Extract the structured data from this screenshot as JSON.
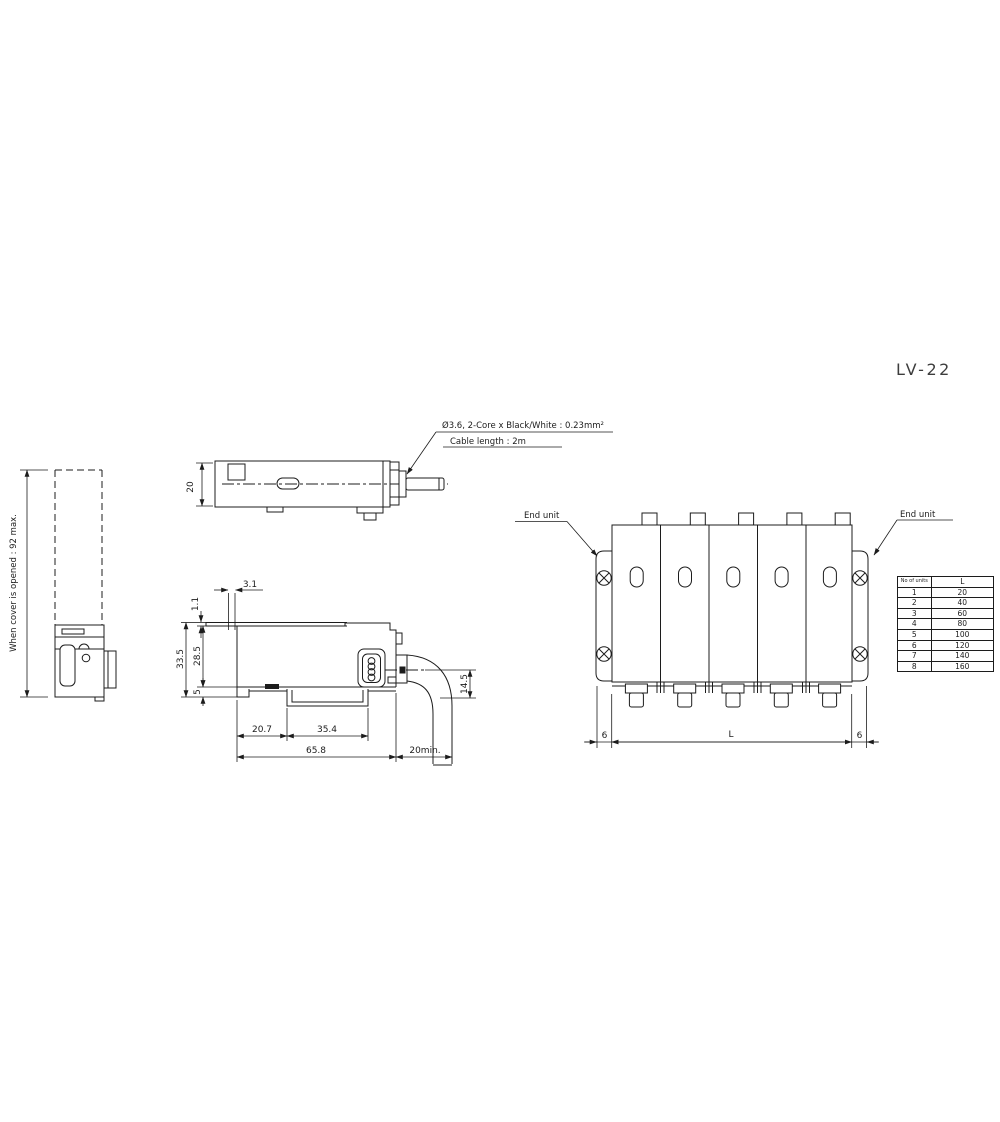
{
  "model_label": "LV-22",
  "cable_note": {
    "line1": "Ø3.6, 2-Core x Black/White : 0.23mm²",
    "line2": "Cable length : 2m"
  },
  "left_view": {
    "cover_note": "When cover is opened : 92 max."
  },
  "top_view": {
    "dim_height": "20"
  },
  "side_view": {
    "dim_tab": "3.1",
    "dim_plate": "1.1",
    "dim_total_height": "33.5",
    "dim_body_height": "28.5",
    "dim_base": "5",
    "dim_left": "20.7",
    "dim_rail": "35.4",
    "dim_width": "65.8",
    "dim_bend": "20min.",
    "dim_cable": "14.5"
  },
  "front_view": {
    "end_unit_left": "End unit",
    "end_unit_right": "End unit",
    "dim_6_left": "6",
    "dim_L": "L",
    "dim_6_right": "6"
  },
  "table": {
    "col1_header": "No of units",
    "col2_header": "L",
    "rows": [
      {
        "n": "1",
        "l": "20"
      },
      {
        "n": "2",
        "l": "40"
      },
      {
        "n": "3",
        "l": "60"
      },
      {
        "n": "4",
        "l": "80"
      },
      {
        "n": "5",
        "l": "100"
      },
      {
        "n": "6",
        "l": "120"
      },
      {
        "n": "7",
        "l": "140"
      },
      {
        "n": "8",
        "l": "160"
      }
    ]
  },
  "colors": {
    "line": "#1c1c1c",
    "background": "#ffffff",
    "title": "#3d3d3d"
  }
}
